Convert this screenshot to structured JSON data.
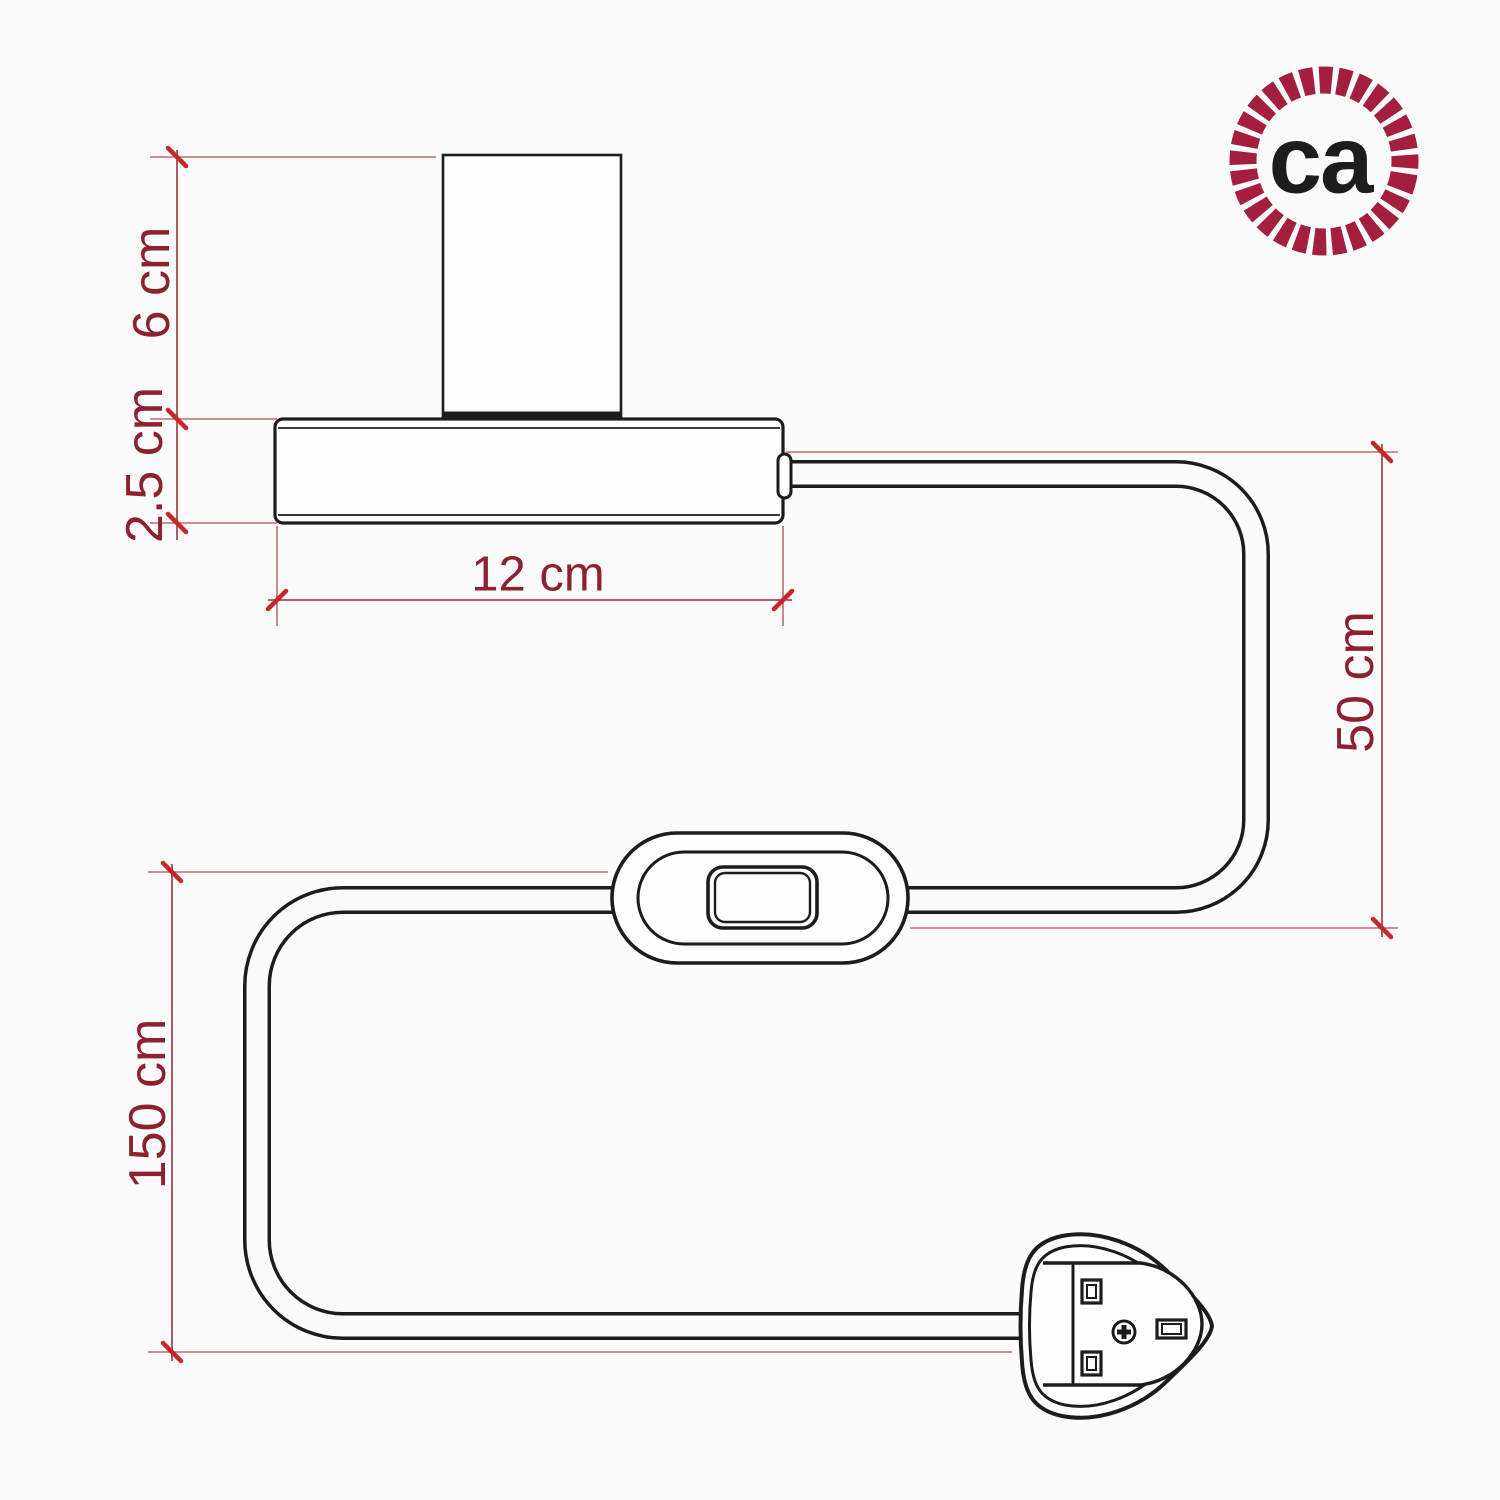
{
  "diagram": {
    "title_hint": "table lamp with inline switch and UK plug - dimension drawing",
    "labels": {
      "lamp_height": "6 cm",
      "base_height": "2.5 cm",
      "base_width": "12 cm",
      "cable_upper": "50 cm",
      "cable_lower": "150 cm"
    },
    "colors": {
      "dimension_text": "#8e2130",
      "dimension_tick": "#c4272e",
      "dimension_line": "#a84a50",
      "extension_line": "#c16a6e",
      "drawing_ink": "#1c1c1c",
      "background": "#fcfbfb"
    }
  },
  "logo": {
    "text": "ca",
    "ring_color": "#a31f3d",
    "text_color": "#1d1d1b"
  }
}
